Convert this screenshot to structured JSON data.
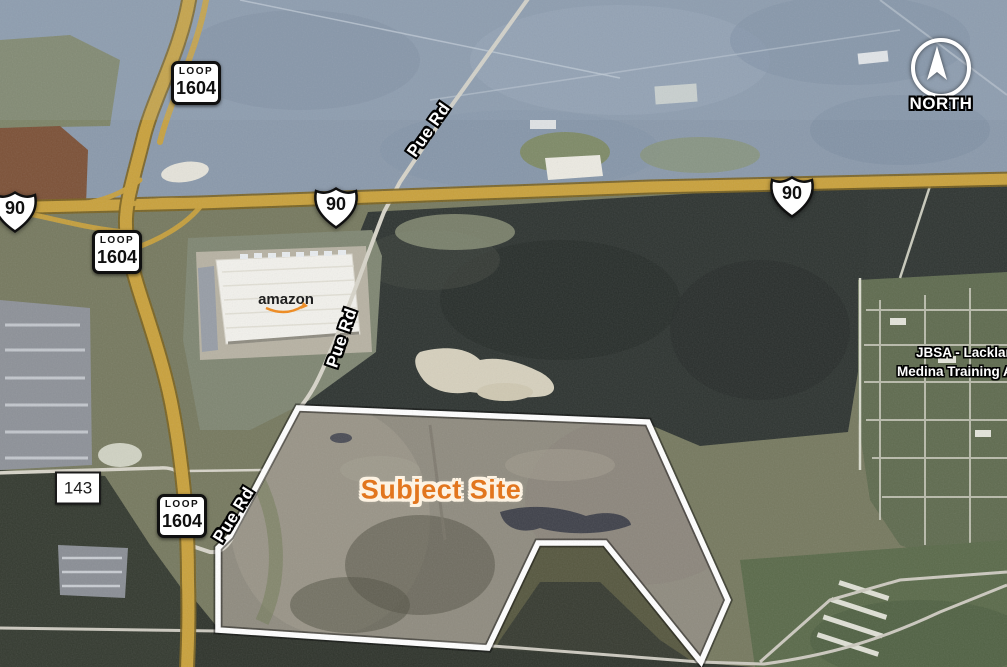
{
  "map": {
    "north_label": "NORTH",
    "subject_site_label": "Subject Site",
    "amazon_label": "amazon",
    "jbsa_line1": "JBSA - Lackland",
    "jbsa_line2": "Medina Training A",
    "pue_rd_labels": [
      "Pue Rd",
      "Pue Rd",
      "Pue Rd"
    ],
    "shields": {
      "loop": {
        "prefix": "LOOP",
        "number": "1604"
      },
      "us90": {
        "number": "90"
      },
      "fm143": {
        "number": "143"
      }
    },
    "colors": {
      "highway": "#c9a13c",
      "boundary": "#ffffff",
      "subject_label": "#e2761e"
    }
  }
}
